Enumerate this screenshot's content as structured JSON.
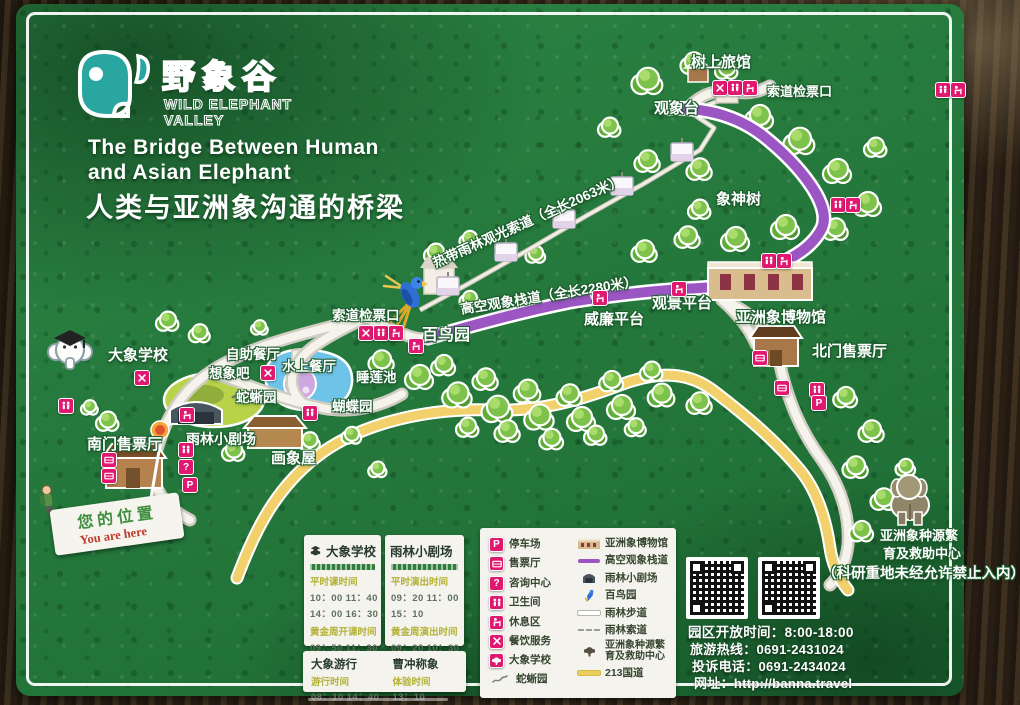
{
  "brand": {
    "logo_cn": "野象谷",
    "logo_en_1": "WILD ELEPHANT",
    "logo_en_2": "VALLEY"
  },
  "title": {
    "en1": "The Bridge Between Human",
    "en2": "and Asian Elephant",
    "zh": "人类与亚洲象沟通的桥梁"
  },
  "map": {
    "labels": {
      "tree_hotel": "树上旅馆",
      "cable_ticket_top": "索道检票口",
      "observation_tower": "观象台",
      "elephant_god_tree": "象神树",
      "cableway": "热带雨林观光索道（全长2063米）",
      "skywalk": "高空观象栈道（全长2280米）",
      "viewing_platform": "观景平台",
      "william_platform": "威廉平台",
      "museum": "亚洲象博物馆",
      "north_ticket": "北门售票厅",
      "cable_ticket_west": "索道检票口",
      "bird_garden": "百鸟园",
      "lily_pond": "睡莲池",
      "butterfly_garden": "蝴蝶园",
      "snake_lizard_garden": "蛇蜥园",
      "buffet": "自助餐厅",
      "imagine_bar": "想象吧",
      "water_restaurant": "水上餐厅",
      "theater": "雨林小剧场",
      "painting_house": "画象屋",
      "south_ticket": "南门售票厅",
      "elephant_school": "大象学校",
      "breeding_center_l1": "亚洲象种源繁",
      "breeding_center_l2": "育及救助中心",
      "research_notice": "（科研重地未经允许禁止入内）"
    },
    "icons": {
      "parking": "P",
      "info": "?",
      "dining": "crossed-utensils",
      "restroom": "two-figures",
      "rest_area": "bench-figure",
      "ticket": "ticket-card"
    }
  },
  "you_are_here": {
    "zh": "您的位置",
    "en": "You are here"
  },
  "legend": {
    "left": [
      {
        "key": "parking",
        "label": "停车场"
      },
      {
        "key": "ticket",
        "label": "售票厅"
      },
      {
        "key": "info",
        "label": "咨询中心"
      },
      {
        "key": "restroom",
        "label": "卫生间"
      },
      {
        "key": "rest",
        "label": "休息区"
      },
      {
        "key": "dining",
        "label": "餐饮服务"
      },
      {
        "key": "school",
        "label": "大象学校"
      },
      {
        "key": "snake",
        "label": "蛇蜥园"
      }
    ],
    "right": [
      {
        "key": "museum",
        "label": "亚洲象博物馆"
      },
      {
        "key": "skywalk",
        "label": "高空观象栈道"
      },
      {
        "key": "theater",
        "label": "雨林小剧场"
      },
      {
        "key": "parrot",
        "label": "百鸟园"
      },
      {
        "key": "trail",
        "label": "雨林步道"
      },
      {
        "key": "ropeway",
        "label": "雨林索道"
      },
      {
        "key": "breed",
        "label": "亚洲象种源繁育及救助中心"
      },
      {
        "key": "road",
        "label": "213国道"
      }
    ]
  },
  "schedules": {
    "elephant_school": {
      "title": "大象学校",
      "sections": [
        {
          "head": "平时课时间",
          "times": [
            "10：00  11：40",
            "14：00  16：30"
          ]
        },
        {
          "head": "黄金周开课时间",
          "times": [
            "09：50  11：30",
            "13：50  15：20",
            "17：00"
          ]
        }
      ]
    },
    "theater": {
      "title": "雨林小剧场",
      "sections": [
        {
          "head": "平时演出时间",
          "times": [
            "09：20  11：00",
            "15：10"
          ]
        },
        {
          "head": "黄金周演出时间",
          "times": [
            "09：20  10：30",
            "12：00  14：20",
            "16：30  17：35"
          ]
        }
      ]
    },
    "extra": {
      "left": {
        "title": "大象游行",
        "head": "游行时间",
        "times": [
          "08：10  14：40"
        ]
      },
      "right": {
        "title": "曹冲称象",
        "head": "体验时间",
        "times": [
          "13：10"
        ]
      }
    }
  },
  "footer": {
    "open_hours": "园区开放时间：8:00-18:00",
    "hotline": "旅游热线：0691-2431024",
    "complaint": "投诉电话：0691-2434024",
    "website": "网址：http://banna.travel"
  },
  "colors": {
    "accent_pink": "#e0186f",
    "skywalk_purple": "#9c56c4",
    "road_yellow": "#f2d06b",
    "board_green": "#27773c"
  }
}
